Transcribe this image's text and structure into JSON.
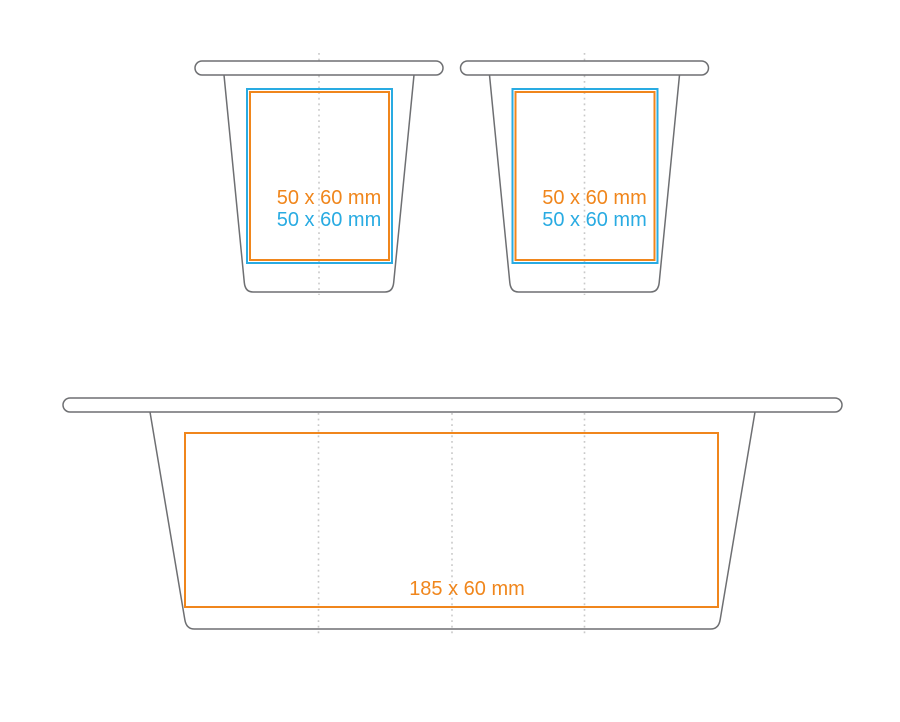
{
  "colors": {
    "outline": "#6e6f72",
    "centerline": "#c9c9c9",
    "orange": "#f0861c",
    "blue": "#29abe2",
    "background": "#ffffff"
  },
  "cup_left": {
    "orange_label": "50 x 60 mm",
    "blue_label": "50 x 60 mm"
  },
  "cup_right": {
    "orange_label": "50 x 60 mm",
    "blue_label": "50 x 60 mm"
  },
  "tub": {
    "orange_label": "185 x 60 mm"
  }
}
